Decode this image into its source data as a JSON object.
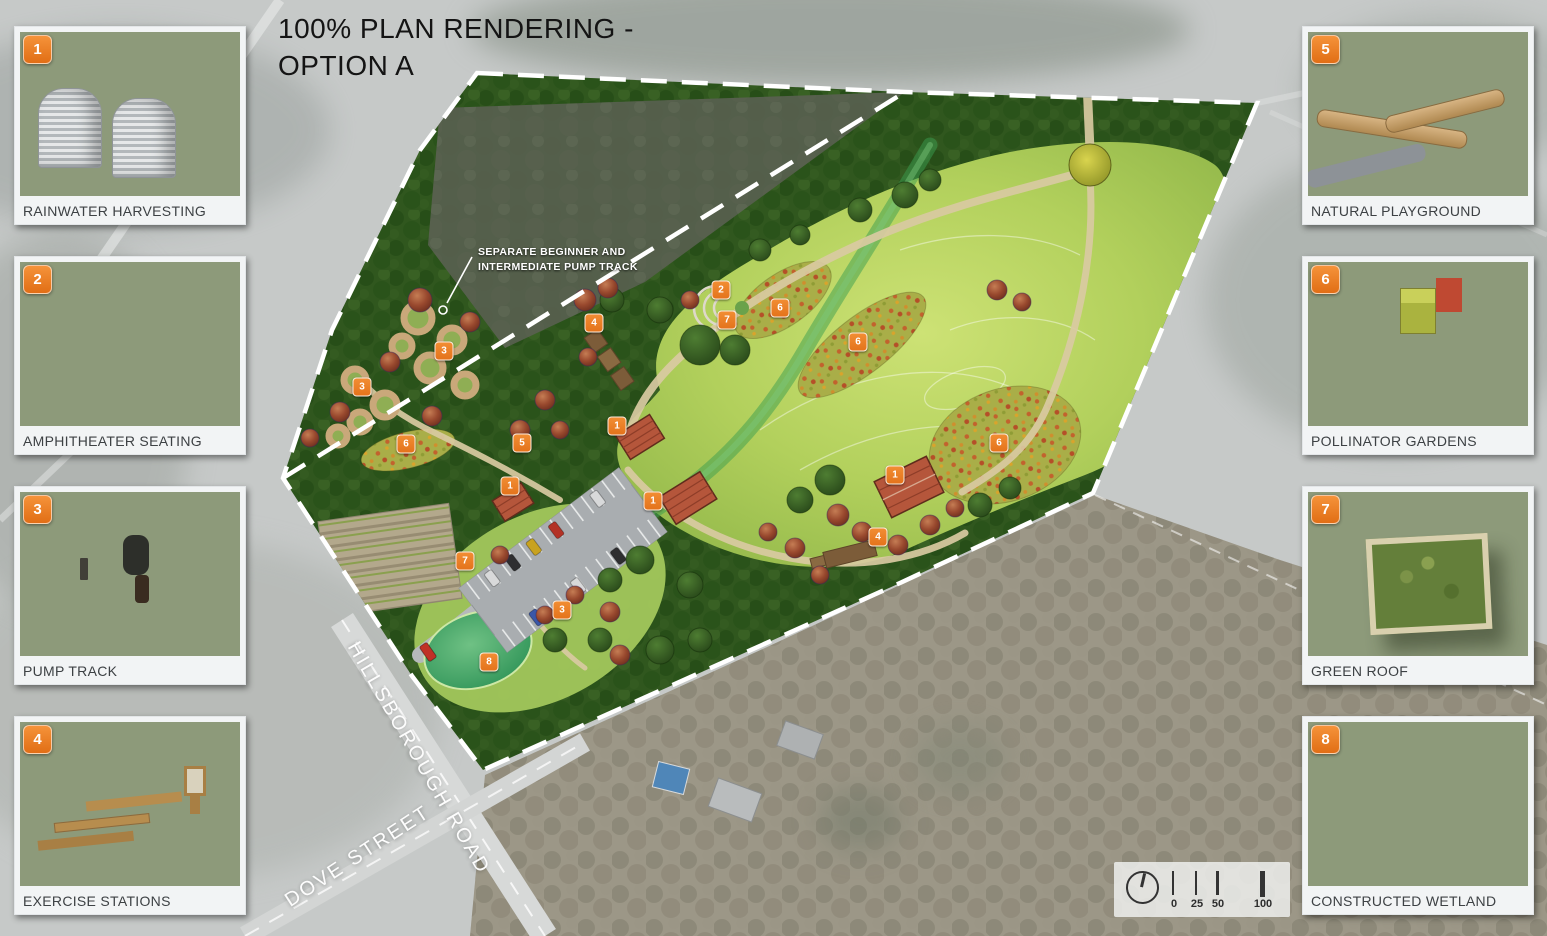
{
  "title": {
    "line1": "100% PLAN RENDERING -",
    "line2": "OPTION A"
  },
  "legend_cards": {
    "left": [
      {
        "number": "1",
        "label": "RAINWATER HARVESTING"
      },
      {
        "number": "2",
        "label": "AMPHITHEATER SEATING"
      },
      {
        "number": "3",
        "label": "PUMP TRACK"
      },
      {
        "number": "4",
        "label": "EXERCISE STATIONS"
      }
    ],
    "right": [
      {
        "number": "5",
        "label": "NATURAL PLAYGROUND"
      },
      {
        "number": "6",
        "label": "POLLINATOR GARDENS"
      },
      {
        "number": "7",
        "label": "GREEN ROOF"
      },
      {
        "number": "8",
        "label": "CONSTRUCTED WETLAND"
      }
    ]
  },
  "plan": {
    "annotation": {
      "line1": "SEPARATE BEGINNER AND",
      "line2": "INTERMEDIATE PUMP TRACK"
    },
    "street_labels": [
      {
        "name": "HILLSBOROUGH ROAD"
      },
      {
        "name": "DOVE STREET"
      }
    ],
    "markers": [
      {
        "number": "3",
        "x": 362,
        "y": 387
      },
      {
        "number": "3",
        "x": 444,
        "y": 351
      },
      {
        "number": "4",
        "x": 594,
        "y": 323
      },
      {
        "number": "2",
        "x": 721,
        "y": 290
      },
      {
        "number": "7",
        "x": 727,
        "y": 320
      },
      {
        "number": "6",
        "x": 780,
        "y": 308
      },
      {
        "number": "6",
        "x": 858,
        "y": 342
      },
      {
        "number": "6",
        "x": 406,
        "y": 444
      },
      {
        "number": "5",
        "x": 522,
        "y": 443
      },
      {
        "number": "1",
        "x": 617,
        "y": 426
      },
      {
        "number": "1",
        "x": 510,
        "y": 486
      },
      {
        "number": "1",
        "x": 653,
        "y": 501
      },
      {
        "number": "6",
        "x": 999,
        "y": 443
      },
      {
        "number": "1",
        "x": 895,
        "y": 475
      },
      {
        "number": "4",
        "x": 878,
        "y": 537
      },
      {
        "number": "7",
        "x": 465,
        "y": 561
      },
      {
        "number": "3",
        "x": 562,
        "y": 610
      },
      {
        "number": "8",
        "x": 489,
        "y": 662
      }
    ]
  },
  "scale_bar": {
    "labels": [
      "0",
      "25",
      "50",
      "100"
    ],
    "north_arrow_icon": "north-arrow-icon"
  },
  "colors": {
    "marker_orange": "#ED7D2B",
    "badge_orange": "#EE7623",
    "boundary_white": "#FFFFFF",
    "lawn_green": "#AECB5C",
    "forest_green": "#30571E"
  }
}
